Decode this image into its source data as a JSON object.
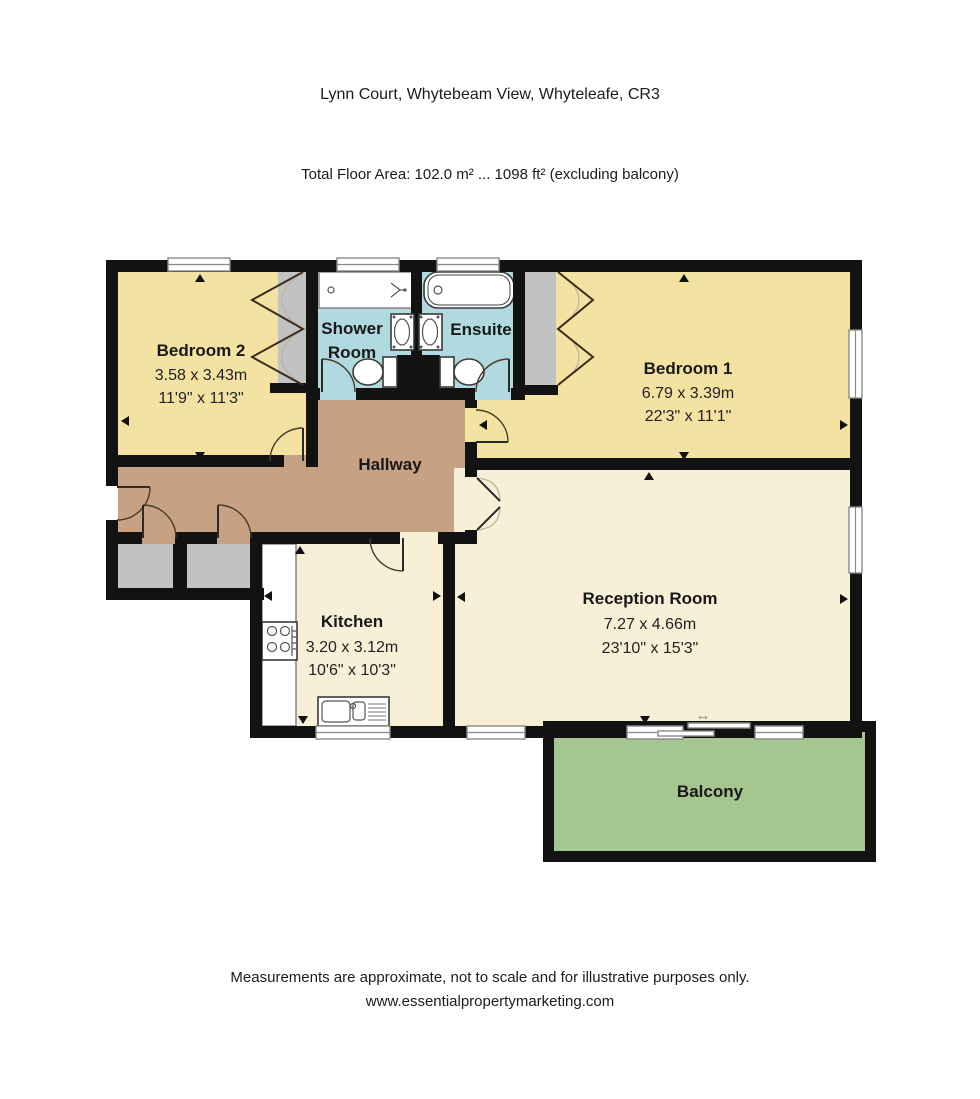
{
  "header": {
    "title": "Lynn Court, Whytebeam View, Whyteleafe, CR3",
    "subtitle": "Total Floor Area: 102.0 m² ... 1098 ft² (excluding balcony)"
  },
  "rooms": {
    "bedroom2": {
      "name": "Bedroom 2",
      "metric": "3.58 x 3.43m",
      "imperial": "11'9\" x 11'3\""
    },
    "shower": {
      "line1": "Shower",
      "line2": "Room"
    },
    "ensuite": {
      "name": "Ensuite"
    },
    "bedroom1": {
      "name": "Bedroom 1",
      "metric": "6.79 x 3.39m",
      "imperial": "22'3\" x 11'1\""
    },
    "hallway": {
      "name": "Hallway"
    },
    "kitchen": {
      "name": "Kitchen",
      "metric": "3.20 x 3.12m",
      "imperial": "10'6\" x 10'3\""
    },
    "reception": {
      "name": "Reception Room",
      "metric": "7.27 x 4.66m",
      "imperial": "23'10\" x 15'3\""
    },
    "balcony": {
      "name": "Balcony"
    }
  },
  "icons": {
    "sliding_door_glyph": "↔"
  },
  "footer": {
    "line1": "Measurements are approximate, not to scale and for illustrative purposes only.",
    "line2": "www.essentialpropertymarketing.com"
  },
  "colors": {
    "wall": "#121212",
    "bedroom": "#f4e2a2",
    "bathroom": "#b0d9e0",
    "hallway": "#c6a183",
    "living": "#f7f0d6",
    "closet": "#c2c2c2",
    "balcony": "#a6c68f"
  }
}
